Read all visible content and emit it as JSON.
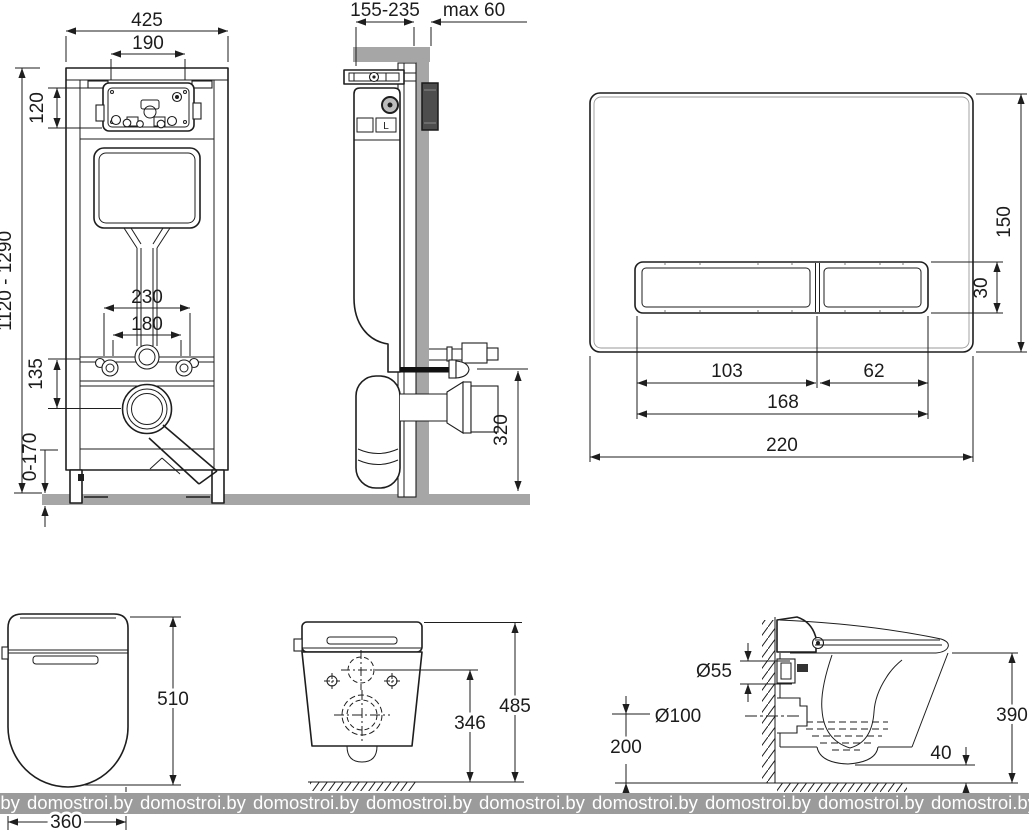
{
  "watermark": {
    "text": "domostroi.by"
  },
  "views": {
    "frame_front": {
      "width": "425",
      "service_width": "190",
      "service_height": "120",
      "height_range": "1120 - 1290",
      "fixing_span_outer": "230",
      "fixing_span_inner": "180",
      "drain_offset": "135",
      "leg_adjust": "0-170"
    },
    "frame_side": {
      "depth_range": "155-235",
      "wall_max": "max 60",
      "drain_height": "320",
      "mark": "L"
    },
    "flush_plate": {
      "width": "220",
      "height": "150",
      "button_height": "30",
      "button_large": "103",
      "button_small": "62",
      "buttons_span": "168"
    },
    "bowl_top": {
      "length": "510",
      "width": "360"
    },
    "bowl_rear": {
      "holes_height": "346",
      "overall_height": "485"
    },
    "bowl_side": {
      "inlet_diameter": "Ø55",
      "outlet_diameter": "Ø100",
      "outlet_axis_height": "200",
      "overall_height": "390",
      "clearance": "40"
    }
  }
}
